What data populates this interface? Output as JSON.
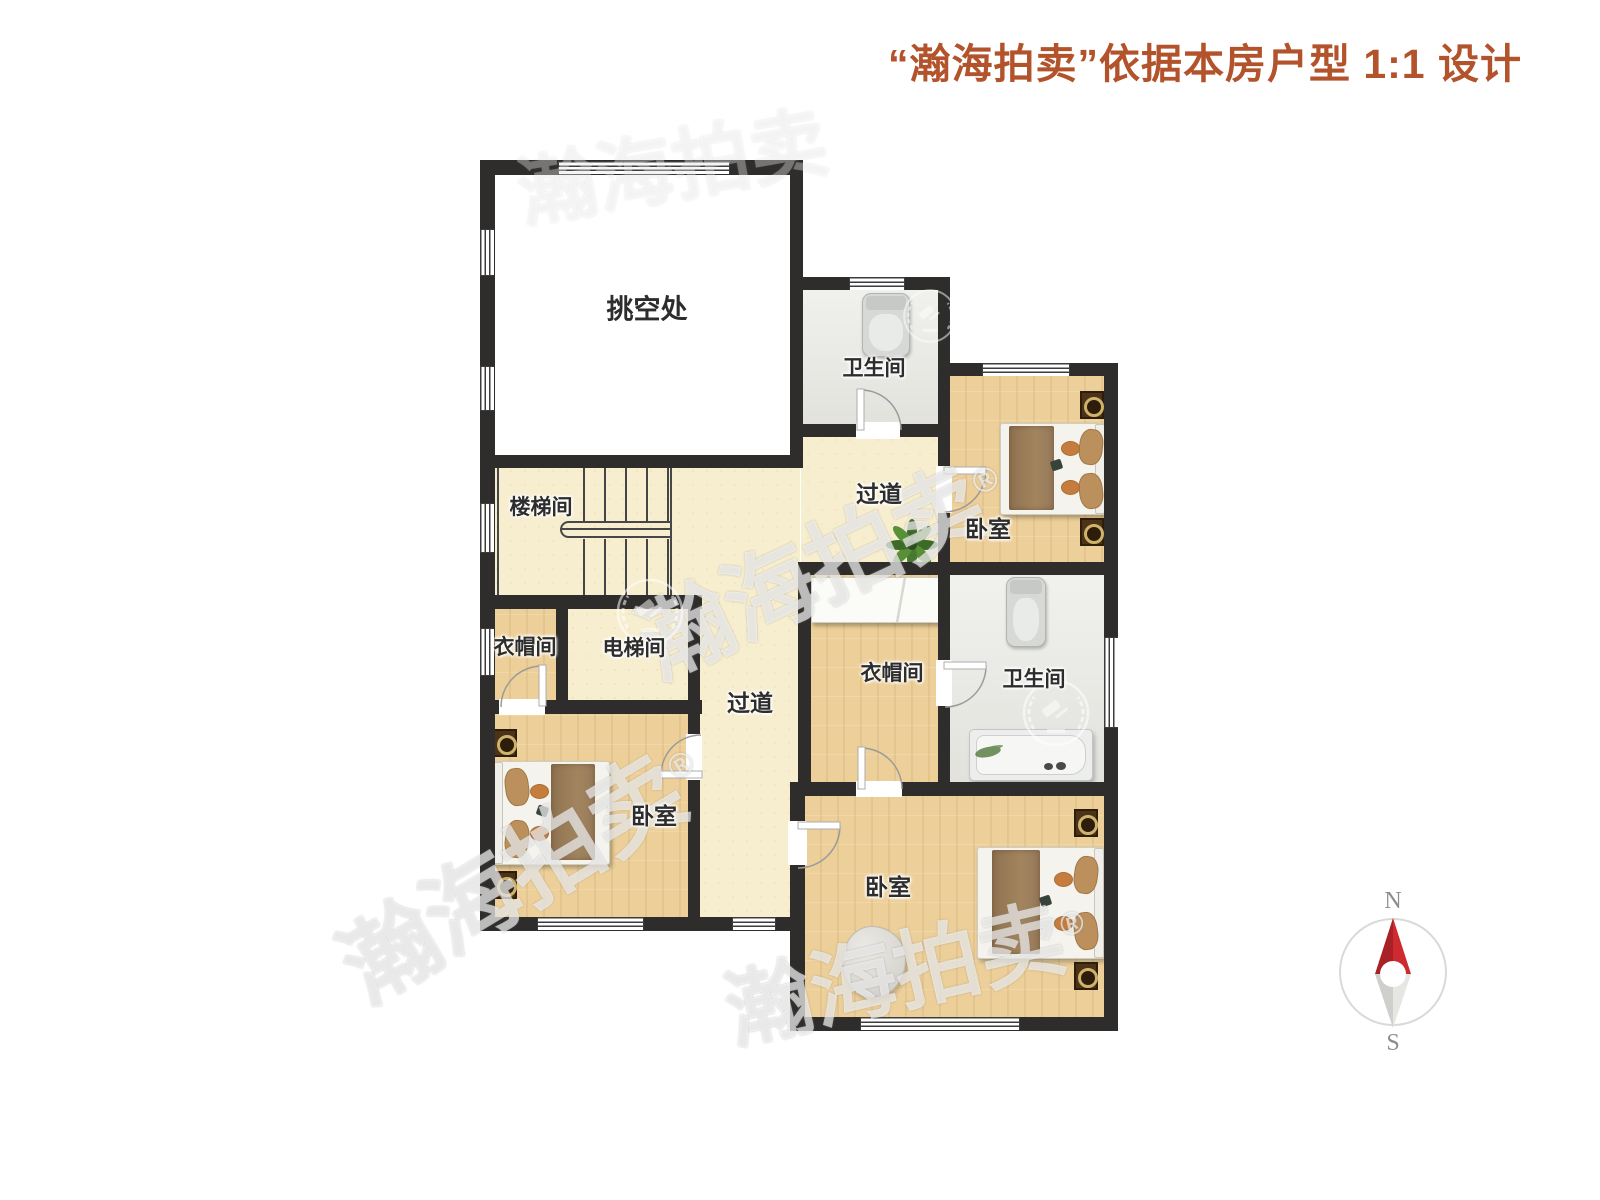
{
  "title": {
    "text": "“瀚海拍卖”依据本房户型 1:1 设计"
  },
  "rooms": {
    "void": {
      "label": "挑空处"
    },
    "bath_top": {
      "label": "卫生间"
    },
    "bed_top_right": {
      "label": "卧室"
    },
    "stairwell": {
      "label": "楼梯间"
    },
    "corridor_upper": {
      "label": "过道"
    },
    "closet_left": {
      "label": "衣帽间"
    },
    "elevator": {
      "label": "电梯间"
    },
    "corridor_lower": {
      "label": "过道"
    },
    "closet_middle": {
      "label": "衣帽间"
    },
    "bath_middle": {
      "label": "卫生间"
    },
    "bed_bottom_left": {
      "label": "卧室"
    },
    "bed_bottom_right": {
      "label": "卧室"
    }
  },
  "compass": {
    "north": "N",
    "south": "S"
  },
  "watermark": {
    "text": "瀚海拍卖",
    "registered": "®"
  },
  "colors": {
    "title_accent": "#b2532c",
    "wall": "#2e2d2b",
    "floor_wood": "#edcf99",
    "floor_corridor": "#f7eecf",
    "floor_bath": "#e9e9e4",
    "compass_north_red": "#c9282e"
  }
}
